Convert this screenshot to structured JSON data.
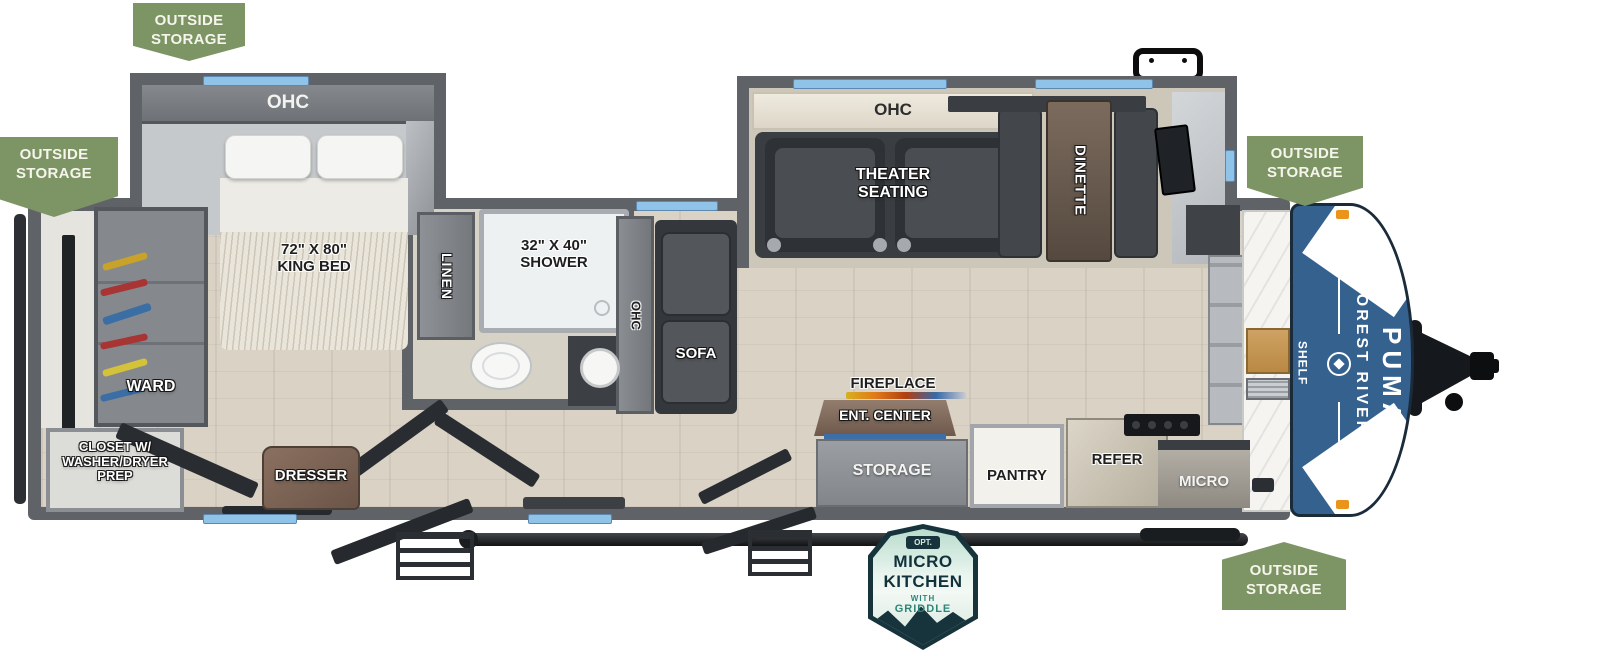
{
  "colors": {
    "badge_green": "#7d9465",
    "wall_gray": "#5f6367",
    "window_blue": "#8fc3e8",
    "cap_blue": "#35618f",
    "marker_orange": "#ea941c",
    "badge_teal": "#2e8577",
    "badge_navy": "#17333c"
  },
  "badges": {
    "outside_storage": {
      "line1": "OUTSIDE",
      "line2": "STORAGE"
    }
  },
  "bedroom": {
    "ohc": "OHC",
    "bed_size": "72\" X 80\"",
    "bed_name": "KING BED",
    "ward": "WARD",
    "closet_line1": "CLOSET W/",
    "closet_line2": "WASHER/DRYER",
    "closet_line3": "PREP",
    "dresser": "DRESSER"
  },
  "bathroom": {
    "linen": "LINEN",
    "shower_size": "32\" X 40\"",
    "shower": "SHOWER"
  },
  "living": {
    "slide_ohc": "OHC",
    "theater_line1": "THEATER",
    "theater_line2": "SEATING",
    "dinette": "DINETTE",
    "sofa_ohc": "OHC",
    "sofa": "SOFA",
    "fireplace": "FIREPLACE",
    "ent_center": "ENT. CENTER",
    "storage": "STORAGE"
  },
  "kitchen": {
    "pantry": "PANTRY",
    "refer": "REFER",
    "micro": "MICRO",
    "shelf": "SHELF"
  },
  "brand": {
    "make": "FOREST RIVER",
    "model": "PUMA"
  },
  "option_badge": {
    "opt": "OPT.",
    "line1": "MICRO",
    "line2": "KITCHEN",
    "line3": "WITH",
    "line4": "GRIDDLE"
  }
}
